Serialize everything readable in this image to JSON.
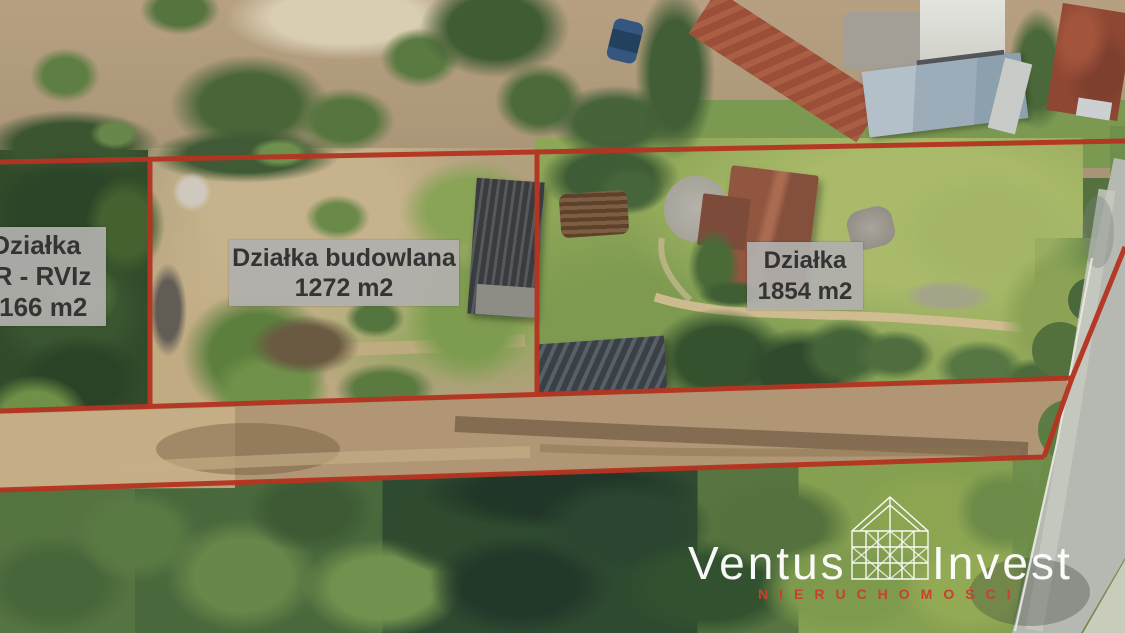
{
  "scene": {
    "type": "aerial-real-estate-photo",
    "description": "Drone aerial photo of land parcels for sale with red boundary overlay"
  },
  "parcels": {
    "left": {
      "name": "Działka",
      "detail": "zR - RVIz",
      "area": "7166 m2"
    },
    "middle": {
      "name": "Działka budowlana",
      "area": "1272 m2"
    },
    "right": {
      "name": "Działka",
      "area": "1854 m2"
    }
  },
  "watermark": {
    "brand_first": "Ventus",
    "brand_second": "Invest",
    "subtitle": "NIERUCHOMOŚCI",
    "logo_icon": "house-wireframe-icon"
  },
  "colors": {
    "boundary_red": "#b43522",
    "label_background": "#b2b0ae",
    "label_text": "#363636",
    "watermark_text": "#ffffff",
    "watermark_subtitle_red": "#c8402e"
  }
}
